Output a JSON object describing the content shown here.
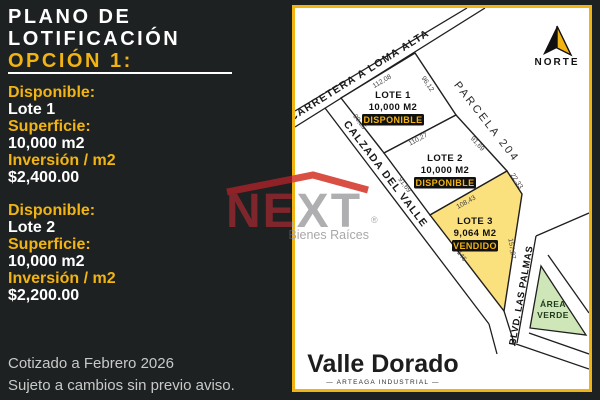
{
  "sidebar": {
    "title_line1": "PLANO DE",
    "title_line2": "LOTIFICACIÓN",
    "option_label": "OPCIÓN 1:",
    "blocks": [
      {
        "available_label": "Disponible:",
        "lot": "Lote 1",
        "surface_label": "Superficie:",
        "surface": "10,000 m2",
        "investment_label": "Inversión / m2",
        "price": "$2,400.00"
      },
      {
        "available_label": "Disponible:",
        "lot": "Lote 2",
        "surface_label": "Superficie:",
        "surface": "10,000 m2",
        "investment_label": "Inversión / m2",
        "price": "$2,200.00"
      }
    ],
    "footnote_line1": "Cotizado a Febrero 2026",
    "footnote_line2": "Sujeto a cambios sin previo aviso."
  },
  "map": {
    "north_label": "NORTE",
    "roads": {
      "carretera": "CARRETERA A LOMA ALTA",
      "calzada": "CALZADA DEL VALLE",
      "blvd": "BLVD. LAS PALMAS"
    },
    "parcel_label": "PARCELA 204",
    "lots": [
      {
        "name": "LOTE 1",
        "area": "10,000 M2",
        "status": "DISPONIBLE"
      },
      {
        "name": "LOTE 2",
        "area": "10,000 M2",
        "status": "DISPONIBLE"
      },
      {
        "name": "LOTE 3",
        "area": "9,064 M2",
        "status": "VENDIDO"
      }
    ],
    "measurements": {
      "lote1_top": "112,08",
      "lote1_right": "96,12",
      "lote1_left": "90,25",
      "lote1_bottom": "110,27",
      "lote2_right": "91,69",
      "lote2_left": "91,69",
      "lote2_bottom": "108,43",
      "lote3_topright": "22,33",
      "lote3_right": "157,27",
      "lote3_left": "146"
    },
    "green_area_line1": "ÁREA",
    "green_area_line2": "VERDE",
    "brand_name": "Valle Dorado",
    "brand_tagline": "— ARTEAGA INDUSTRIAL —"
  },
  "watermark": {
    "brand": "NEXT",
    "registered": "®",
    "tagline": "Bienes Raíces"
  },
  "colors": {
    "accent_yellow": "#F2B413",
    "sidebar_bg": "#1D2121",
    "lot_sold_fill": "#FBE07E",
    "green_area_fill": "#CFE7B8",
    "logo_red": "#D94F43"
  }
}
